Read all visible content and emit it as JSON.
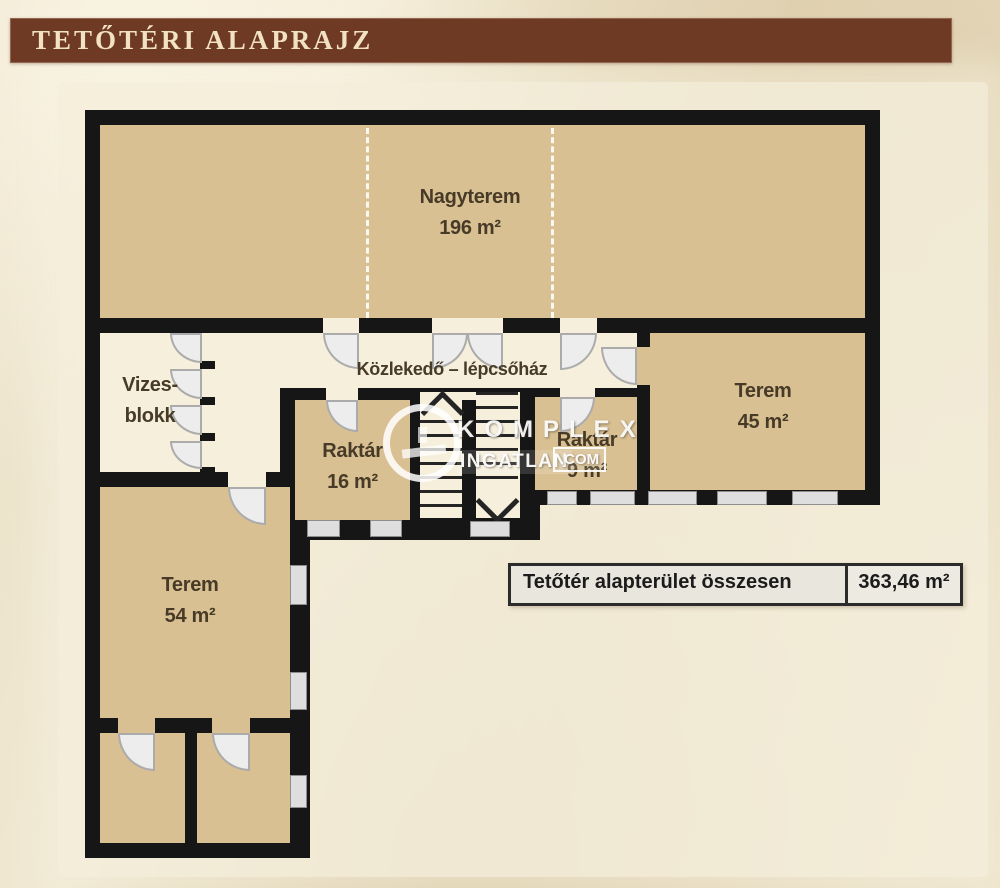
{
  "header": {
    "title": "TETŐTÉRI ALAPRAJZ"
  },
  "rooms": {
    "nagyterem": {
      "line1": "Nagyterem",
      "line2": "196 m²"
    },
    "vizesblokk": {
      "line1": "Vizes-",
      "line2": "blokk"
    },
    "kozlekedo": {
      "line1": "Közlekedő – lépcsőház"
    },
    "raktar16": {
      "line1": "Raktár",
      "line2": "16 m²"
    },
    "raktar9": {
      "line1": "Raktár",
      "line2": "9 m²"
    },
    "terem45": {
      "line1": "Terem",
      "line2": "45 m²"
    },
    "terem54": {
      "line1": "Terem",
      "line2": "54 m²"
    }
  },
  "summary": {
    "label": "Tetőtér alapterület összesen",
    "value": "363,46 m²"
  },
  "watermark": {
    "brand": "KOMPLEX",
    "brand2": "INGATLAN",
    "tld": ".COM"
  },
  "colors": {
    "header-bar": "#6f3a23",
    "header-text": "#f2e2c4",
    "wall": "#161616",
    "room-tan": "#d9c093",
    "room-cream": "#f6efdc",
    "window-fill": "#dedede",
    "door-fill": "#ededed",
    "paper": "#f5efdc",
    "page-bg": "#e8ddc2",
    "label-text": "#473b28",
    "summary-bg": "#e9e6dd",
    "summary-border": "#2b2b2b"
  }
}
